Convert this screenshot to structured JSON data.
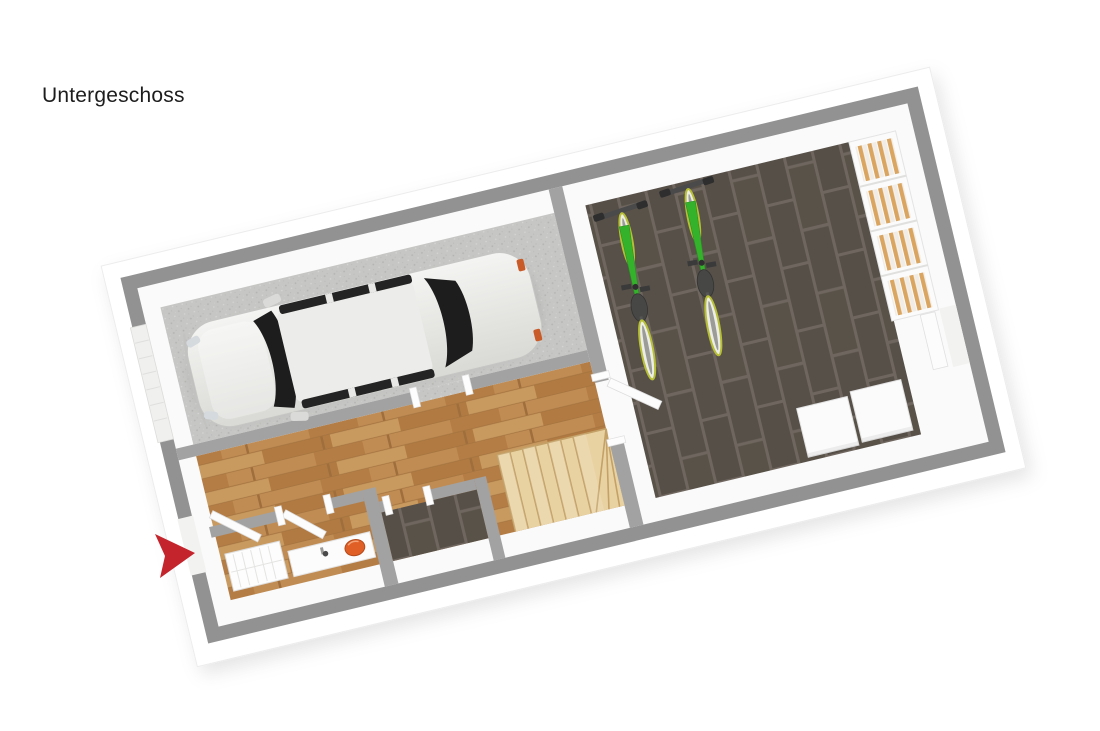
{
  "title": "Untergeschoss",
  "floorplan": {
    "type": "3d-floor-plan",
    "rotation_deg": -13.5,
    "colors": {
      "background": "#ffffff",
      "wall": "#929292",
      "wall_inner": "#a2a2a2",
      "wall_face": "#fafafa",
      "garage_floor": "#c6c6c4",
      "wood_floor": "#bc8850",
      "tile_floor": "#575049",
      "tile_grout": "#6f675f",
      "stair_wood": "#e9d2a2",
      "stair_edge": "#c3a167",
      "shelf_white": "#fbfbfb",
      "binder_tan": "#d9a561",
      "box_white": "#fbfbfb",
      "bike_green": "#35b22c",
      "bike_wheel_rim": "#b7bf35",
      "car_glass": "#1d1d1d",
      "sink_orange": "#e05f26",
      "arrow_red": "#c4242c",
      "door_white": "#f2f2f0"
    },
    "objects": [
      "station-wagon-car",
      "bicycle",
      "bicycle",
      "shelf-with-binders",
      "storage-box",
      "storage-box",
      "wooden-staircase",
      "washbasin-with-orange-bowl",
      "radiator",
      "entrance-arrow"
    ]
  }
}
